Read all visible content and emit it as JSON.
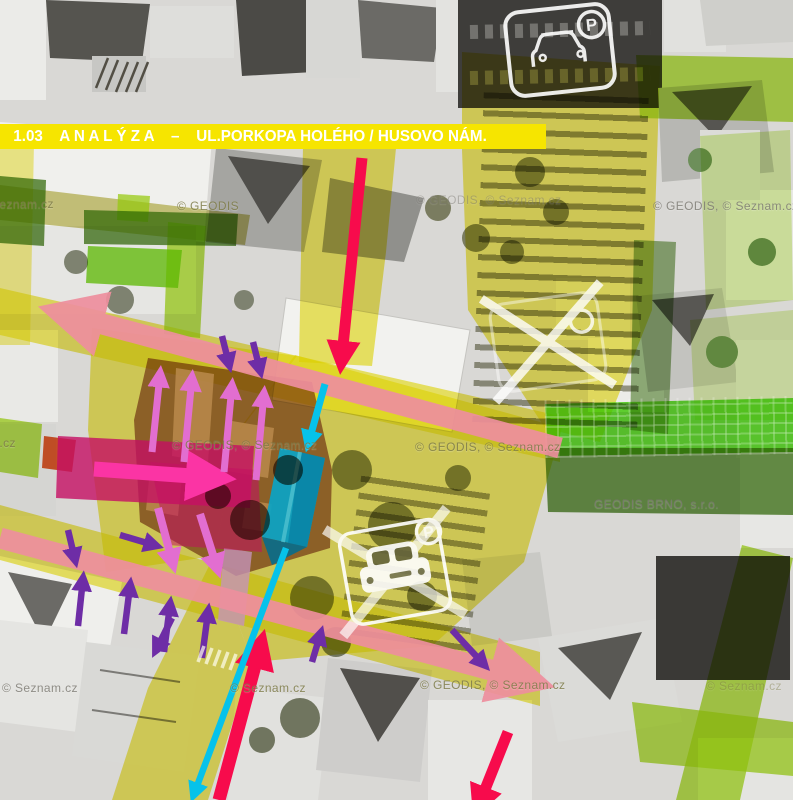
{
  "page": {
    "title_bar": "1.03    A N A L Ý Z A    –    UL.PORKOPA HOLÉHO / HUSOVO NÁM."
  },
  "watermarks": [
    {
      "text": "© Seznam.cz"
    },
    {
      "text": "© GEODIS"
    },
    {
      "text": "© GEODIS, © Seznam.cz"
    },
    {
      "text": "© GEODIS, © Seznam.cz"
    },
    {
      "text": "© Seznam.cz"
    },
    {
      "text": "© GEODIS, © Seznam.cz"
    },
    {
      "text": "© GEODIS, © Seznam.cz"
    },
    {
      "text": "GEODIS BRNO, s.r.o."
    },
    {
      "text": "© Seznam.cz"
    },
    {
      "text": "© Seznam.cz"
    },
    {
      "text": "© GEODIS, © Seznam.cz"
    },
    {
      "text": "© Seznam.cz"
    }
  ],
  "icons": {
    "parking_badge": "P"
  },
  "colors": {
    "title_yellow": "#f6e500",
    "yellow": "#e8dc00",
    "olive": "#9c9400",
    "lime": "#9fd70e",
    "bright_green": "#3fd600",
    "dark_green": "#2e6b00",
    "salmon": "#ee8f9e",
    "hot_pink": "#fb34a4",
    "deep_pink": "#e81277",
    "maroon": "#6d1a05",
    "tan": "#dba35a",
    "orange_red": "#e04008",
    "lavender": "#e9aede",
    "cyan": "#06c2ea",
    "red": "#f70b4c",
    "orchid": "#e26ed0",
    "purple": "#6e2da6"
  }
}
